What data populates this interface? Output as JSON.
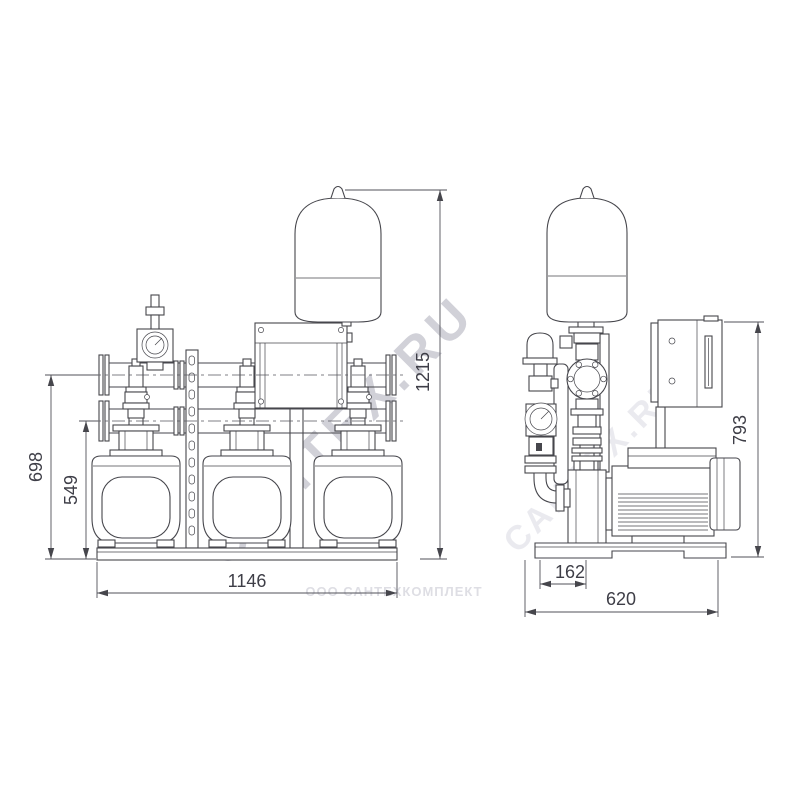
{
  "drawing": {
    "front_view": {
      "dim_width": "1146",
      "dim_height_total": "1215",
      "dim_height_discharge_manifold": "698",
      "dim_height_suction_manifold": "549"
    },
    "side_view": {
      "dim_depth": "620",
      "dim_pipe_offset": "162",
      "dim_height_cabinet": "793"
    },
    "watermarks": {
      "diagonal_primary": "САНТЕХ.RU",
      "diagonal_secondary": "САНТЕХ.RU",
      "bottom_line": "ООО САНТЕХКОМПЛЕКТ"
    },
    "colors": {
      "line": "#46464c",
      "dim_text": "#3e3e47",
      "watermark_primary": "#c9c9d2",
      "watermark_faint": "#e6e6ec",
      "background": "#ffffff"
    }
  }
}
